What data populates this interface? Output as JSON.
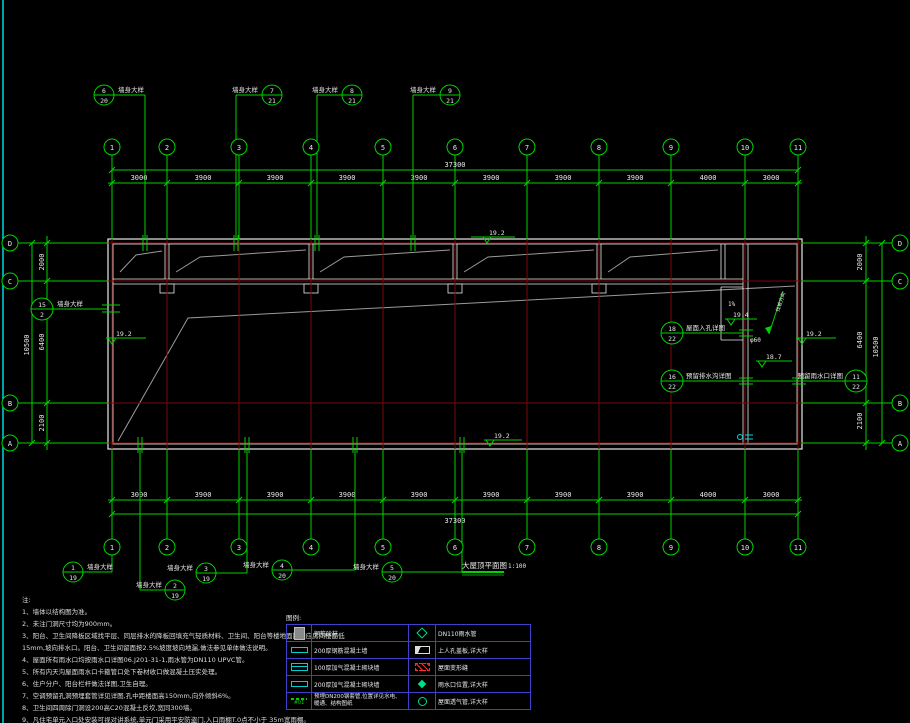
{
  "colors": {
    "bg": "#000000",
    "line_green": "#00d400",
    "grid_red": "#7a0808",
    "wall_white": "#e8e8e8",
    "slope_gray": "#9a9a9a",
    "cyan": "#00d8d8",
    "legend_border": "#4040cc",
    "blue_text": "#6b7bff"
  },
  "plan": {
    "title": "大屋顶平面图",
    "scale": "1:100"
  },
  "grid": {
    "cols": [
      "1",
      "2",
      "3",
      "4",
      "5",
      "6",
      "7",
      "8",
      "9",
      "10",
      "11"
    ],
    "rows": [
      "D",
      "C",
      "B",
      "A"
    ]
  },
  "dims": {
    "top_spans": [
      "3000",
      "3900",
      "3900",
      "3900",
      "3900",
      "3900",
      "3900",
      "3900",
      "4000",
      "3000"
    ],
    "bottom_spans": [
      "3000",
      "3900",
      "3900",
      "3900",
      "3900",
      "3900",
      "3900",
      "3900",
      "4000",
      "3000"
    ],
    "top_total": "37300",
    "bottom_total": "37300",
    "left_spans": [
      "2000",
      "6400",
      "2100"
    ],
    "right_spans": [
      "2000",
      "6400",
      "2100"
    ],
    "left_total": "10500",
    "right_total": "10500"
  },
  "levels": [
    "19.2",
    "19.2",
    "19.4",
    "19.2",
    "18.7",
    "19.2"
  ],
  "callouts": {
    "top": [
      {
        "num": "6",
        "sheet": "20",
        "label": "墙身大样"
      },
      {
        "num": "7",
        "sheet": "21",
        "label": "墙身大样"
      },
      {
        "num": "8",
        "sheet": "21",
        "label": "墙身大样"
      },
      {
        "num": "9",
        "sheet": "21",
        "label": "墙身大样"
      }
    ],
    "bottom": [
      {
        "num": "1",
        "sheet": "19",
        "label": "墙身大样"
      },
      {
        "num": "2",
        "sheet": "19",
        "label": "墙身大样"
      },
      {
        "num": "3",
        "sheet": "19",
        "label": "墙身大样"
      },
      {
        "num": "4",
        "sheet": "20",
        "label": "墙身大样"
      },
      {
        "num": "5",
        "sheet": "20",
        "label": "墙身大样"
      }
    ],
    "left": [
      {
        "num": "15",
        "sheet": "2",
        "label": "墙身大样"
      }
    ],
    "right": [
      {
        "num": "18",
        "sheet": "22",
        "label": "屋面入孔详图"
      },
      {
        "num": "16",
        "sheet": "22",
        "label": "预留排水沟详图"
      },
      {
        "num": "11",
        "sheet": "22",
        "label": "预留雨水口详图"
      }
    ]
  },
  "annotations": {
    "slope": "1%",
    "pipe": "φ60",
    "arrow_label": "找坡方向"
  },
  "notes": {
    "title": "注:",
    "lines": [
      "1、墙体以结构图为准。",
      "2、未注门洞尺寸均为900mm。",
      "3、阳台、卫生间降板区域找平层、同层排水的降板回填充气轻质材料、卫生间、阳台等楼地面比相应房间楼面低",
      "15mm,坡向排水口。阳台、卫生间留面按2.5%坡度坡向地漏,做法参见单体做法说明。",
      "4、屋面所有雨水口均按雨水口详图06.J201-31-1,雨水管为DN110 UPVC管。",
      "5、所有内天沟屋面雨水口卡箍管口处下卷材收口做混凝土压实处理。",
      "6、住户分户、阳台栏杆做法详图,卫生自理。",
      "7、空调预留孔洞预埋套管详见详图,孔中距楼面高150mm,向外倾斜6%。",
      "8、卫生间四周除门洞设200高C20混凝土反坎,宽同300墙。",
      "9、凡住宅单元入口处安装可视对讲系统,单元门采用平安防盗门,入口雨棚T.0点不小于 35m宽雨棚。"
    ]
  },
  "legend": {
    "title": "图例:",
    "sleeve_tag": "#01",
    "rows": [
      {
        "left_text": "钢筋砼柱",
        "right_text": "DN110雨水管"
      },
      {
        "left_text": "200厚钢筋混凝土墙",
        "right_text": "上人孔盖板,详大样"
      },
      {
        "left_text": "100厚加气混凝土砌块墙",
        "right_text": "屋面变形缝"
      },
      {
        "left_text": "200厚加气混凝土砌块墙",
        "right_text": "雨水口位置,详大样"
      },
      {
        "left_text": "预埋DN200钢套管,位置详见水电、暖通、结构图纸",
        "right_text": "屋面透气管,详大样"
      }
    ]
  }
}
